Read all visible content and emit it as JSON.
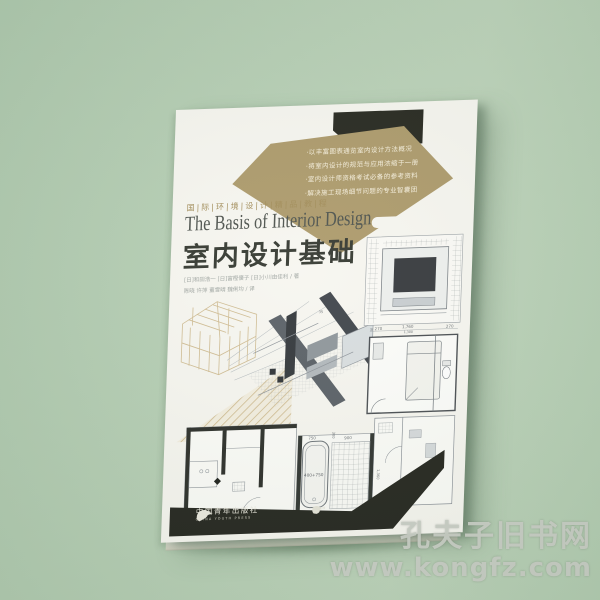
{
  "photo": {
    "background_color": "#b6ceb4",
    "watermark": {
      "line1": "孔夫子旧书网",
      "line2": "www.kongfz.com"
    }
  },
  "cover": {
    "series_title": "国|际|环|境|设|计|精|品|教|程",
    "title_en": "The Basis of Interior Design",
    "title_zh": "室内设计基础",
    "bullets": [
      "·以丰富图表通览室内设计方法概况",
      "·将室内设计的规范与应用浓缩于一册",
      "·室内设计师资格考试必备的参考资料",
      "·解决施工现场细节问题的专业智囊团"
    ],
    "authors": [
      "[日]和田浩一 [日]富樫優子 [日]小川由佳利 / 著",
      "陈晓 许萍 董雪晴 魏俐均 / 译"
    ],
    "publisher": {
      "name_zh": "中国青年出版社",
      "name_en": "CHINA YOUTH PRESS",
      "imprint": "中青雄狮"
    },
    "colors": {
      "gold_banner": "#ad9a6b",
      "black_corner": "#26271f",
      "bottom_band": "#24251e",
      "cover_paper": "#f7f6f0"
    }
  },
  "dims": {
    "d270l": "≤ 270",
    "d1760": "1,760",
    "d1300": "1,300",
    "d270r": "270",
    "d750": "750",
    "d900": "900",
    "d300": "300",
    "d1360": "1,360",
    "tub": "400+750",
    "d35": "35"
  }
}
